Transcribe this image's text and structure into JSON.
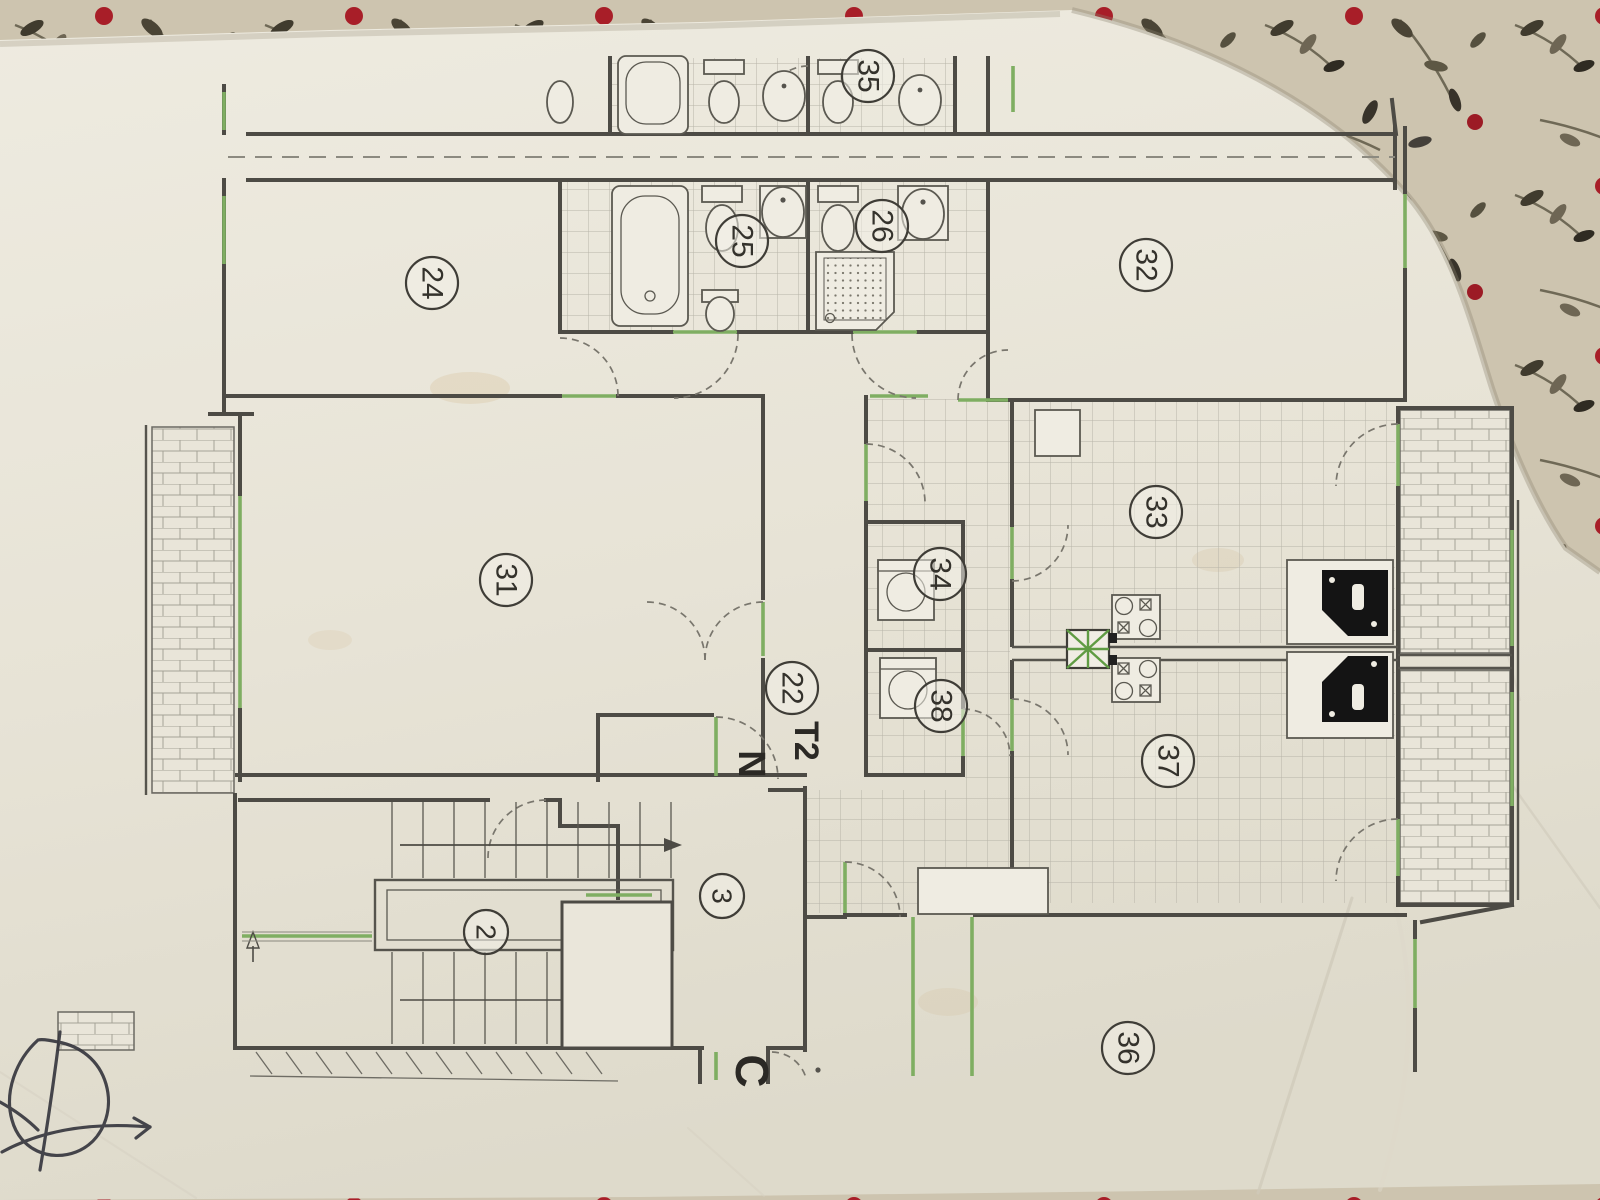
{
  "plan": {
    "title_note": "apartment floor plan photographed on fabric",
    "unit_letters": [
      {
        "t": "T2",
        "x": 806,
        "y": 741,
        "size": 34
      },
      {
        "t": "N",
        "x": 751,
        "y": 764,
        "size": 38
      },
      {
        "t": "C",
        "x": 752,
        "y": 1071,
        "size": 46
      }
    ],
    "room_labels": [
      {
        "n": "35",
        "x": 868,
        "y": 76
      },
      {
        "n": "24",
        "x": 432,
        "y": 283
      },
      {
        "n": "25",
        "x": 742,
        "y": 241
      },
      {
        "n": "26",
        "x": 882,
        "y": 226
      },
      {
        "n": "32",
        "x": 1146,
        "y": 265
      },
      {
        "n": "31",
        "x": 506,
        "y": 580
      },
      {
        "n": "22",
        "x": 792,
        "y": 688
      },
      {
        "n": "34",
        "x": 940,
        "y": 574
      },
      {
        "n": "33",
        "x": 1156,
        "y": 512
      },
      {
        "n": "38",
        "x": 941,
        "y": 706
      },
      {
        "n": "37",
        "x": 1168,
        "y": 761
      },
      {
        "n": "2",
        "x": 486,
        "y": 932
      },
      {
        "n": "3",
        "x": 722,
        "y": 896
      },
      {
        "n": "36",
        "x": 1128,
        "y": 1048
      }
    ],
    "colors": {
      "paper": "#eae6da",
      "wall_ink": "#4d4b45",
      "window_green": "#7fae62",
      "label_ink": "#34322c",
      "fabric_base": "#cdc4af",
      "berry_red": "#a81e28",
      "pen_ink": "#34343c"
    },
    "fixtures": [
      "bathtub-icon",
      "toilet-icon",
      "bidet-icon",
      "washbasin-icon",
      "shower-icon",
      "washing-machine-icon",
      "stove-icon",
      "kitchen-sink-icon",
      "vent-shaft-icon",
      "staircase-icon",
      "elevator-icon",
      "balcony-tiles",
      "pen-scribble"
    ]
  }
}
